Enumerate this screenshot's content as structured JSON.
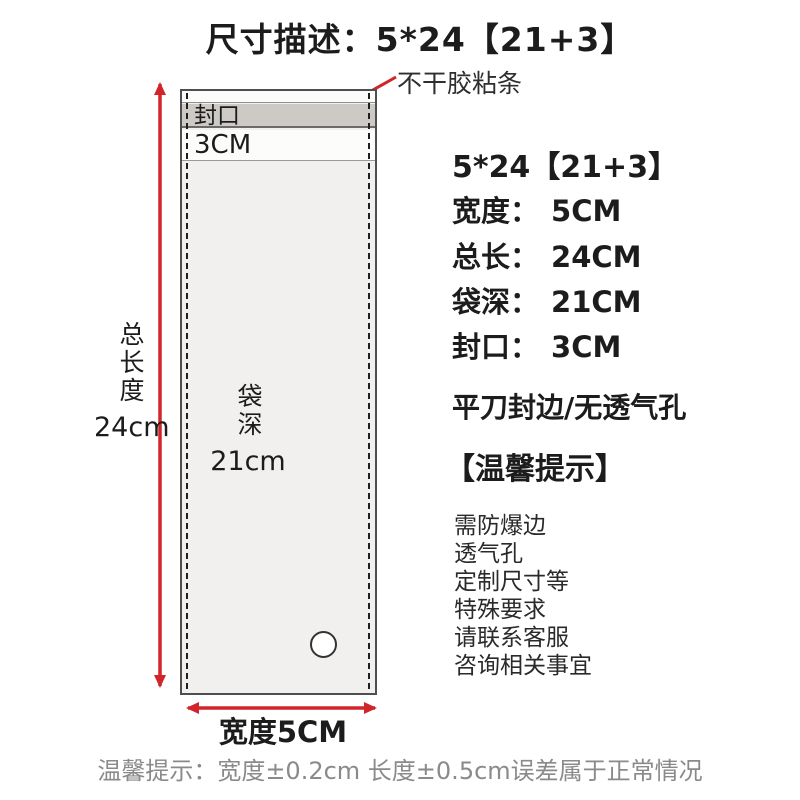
{
  "colors": {
    "red": "#d0262b",
    "bag-body": "#f1f0ee",
    "seal-strip": "#cdc9c5",
    "strip-white": "#fcfcfb",
    "bag-border": "#4f4f4f",
    "text": "#1c1c1c",
    "muted": "#8a8a8a"
  },
  "title": "尺寸描述：5*24【21+3】",
  "callout": {
    "label": "不干胶粘条"
  },
  "bag": {
    "seal_label": "封口",
    "seal_height": "3CM",
    "depth_label": "袋深",
    "depth_value": "21cm",
    "length_label": "总长度",
    "length_value": "24cm",
    "width_label": "宽度5CM"
  },
  "specs": {
    "heading": "5*24【21+3】",
    "rows": [
      {
        "label": "宽度：",
        "value": "5CM"
      },
      {
        "label": "总长：",
        "value": "24CM"
      },
      {
        "label": "袋深：",
        "value": "21CM"
      },
      {
        "label": "封口：",
        "value": "3CM"
      }
    ],
    "edge_note": "平刀封边/无透气孔",
    "tips_heading": "【温馨提示】",
    "tips": [
      "需防爆边",
      "透气孔",
      "定制尺寸等",
      "特殊要求",
      "请联系客服",
      "咨询相关事宜"
    ]
  },
  "footer_note": "温馨提示：宽度±0.2cm 长度±0.5cm误差属于正常情况"
}
